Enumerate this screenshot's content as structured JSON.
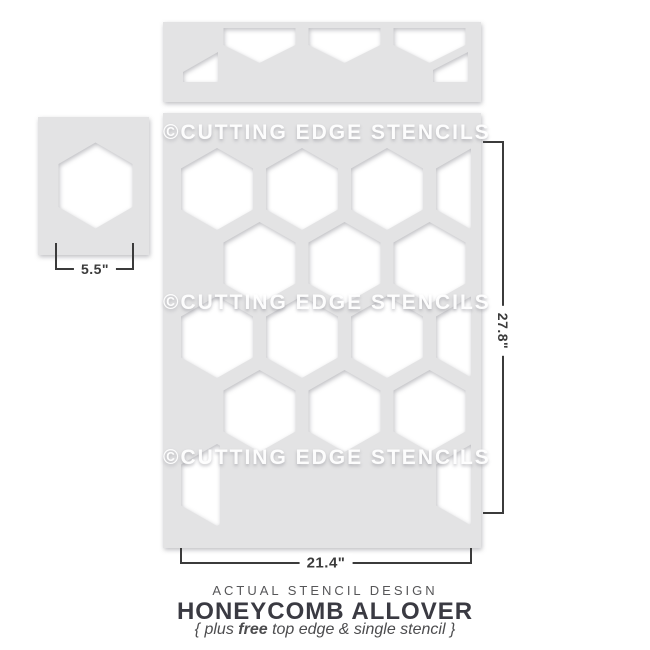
{
  "watermark": {
    "text": "©CUTTING EDGE STENCILS"
  },
  "dimensions": {
    "single_stencil_width": "5.5\"",
    "main_stencil_width": "21.4\"",
    "main_stencil_height": "27.8\""
  },
  "caption": {
    "kicker": "ACTUAL STENCIL DESIGN",
    "title": "HONEYCOMB ALLOVER",
    "tagline_prefix": "{ plus ",
    "tagline_bold": "free",
    "tagline_suffix": " top edge & single stencil }"
  },
  "colors": {
    "stencil_sheet": "#e3e3e4",
    "cutout": "#ffffff",
    "dimension_line": "#3b3b3b",
    "title_text": "#3a3a42",
    "muted_text": "#565658"
  }
}
